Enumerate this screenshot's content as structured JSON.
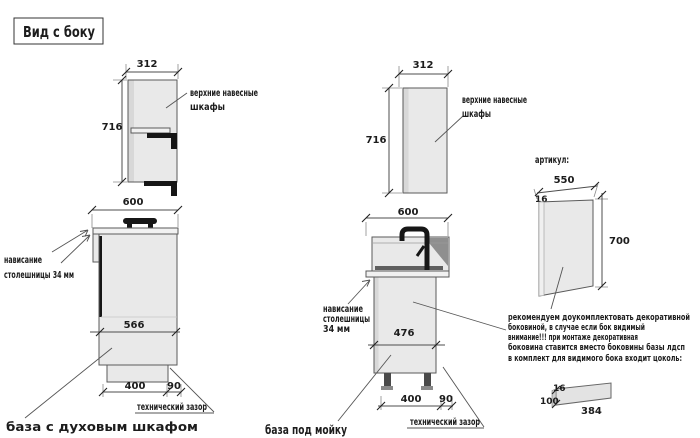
{
  "title": "Вид с боку",
  "colors": {
    "red_text": "#c23b36",
    "text": "#1c1c1c",
    "line": "#4d4d4d"
  },
  "oven_unit": {
    "upper": {
      "width": "312",
      "height": "716",
      "label": [
        "верхние навесные",
        "шкафы"
      ]
    },
    "base": {
      "width": "600",
      "front_height": "566",
      "plinth_width": "400",
      "gap_width": "90",
      "overhang": [
        "нависание",
        "столешницы 34 мм"
      ],
      "tech_gap": "технический зазор",
      "caption": "база с духовым шкафом"
    }
  },
  "sink_unit": {
    "upper": {
      "width": "312",
      "height": "716",
      "label": [
        "верхние навесные",
        "шкафы"
      ]
    },
    "base": {
      "width": "600",
      "front_height": "476",
      "plinth_width": "400",
      "gap_width": "90",
      "overhang": [
        "нависание",
        "столешницы",
        "34 мм"
      ],
      "tech_gap": "технический зазор",
      "caption": "база под мойку"
    }
  },
  "side_panel": {
    "heading": "артикул:",
    "width": "550",
    "thickness": "16",
    "height": "700",
    "note": [
      "рекомендуем доукомплектовать декоративной",
      "боковиной, в случае если бок видимый",
      "внимание!!! при монтаже декоративная",
      "боковина ставится вместо боковины базы лдсп",
      "в комплект для видимого бока входит цоколь:"
    ],
    "plinth": {
      "thickness": "16",
      "height": "100",
      "length": "384"
    }
  }
}
